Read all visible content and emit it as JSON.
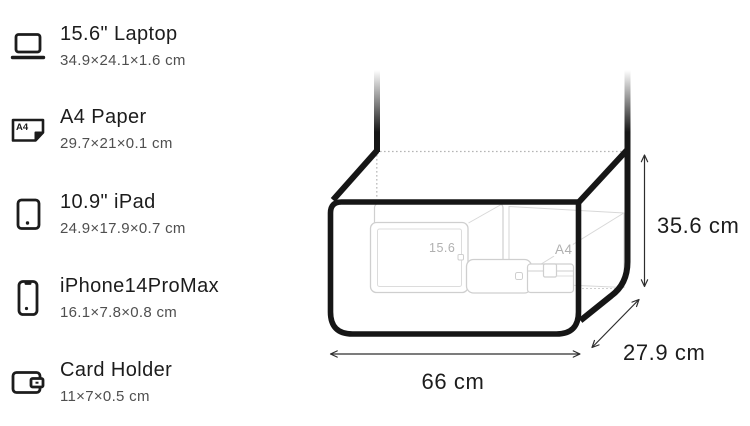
{
  "items_panel": {
    "a4_icon_text": "A4",
    "items": [
      {
        "icon": "laptop-icon",
        "title": "15.6\" Laptop",
        "dimensions": "34.9×24.1×1.6 cm"
      },
      {
        "icon": "a4-paper-icon",
        "title": "A4 Paper",
        "dimensions": "29.7×21×0.1 cm"
      },
      {
        "icon": "ipad-icon",
        "title": "10.9\" iPad",
        "dimensions": "24.9×17.9×0.7 cm"
      },
      {
        "icon": "iphone-icon",
        "title": "iPhone14ProMax",
        "dimensions": "16.1×7.8×0.8 cm"
      },
      {
        "icon": "card-holder-icon",
        "title": "Card Holder",
        "dimensions": "11×7×0.5 cm"
      }
    ]
  },
  "diagram": {
    "bag_width_label": "66 cm",
    "bag_depth_label": "27.9 cm",
    "bag_height_label": "35.6 cm",
    "inner_tags": {
      "laptop": "15.6",
      "a4_paper": "A4"
    }
  },
  "colors": {
    "bag_outline": "#161616",
    "faint_item_stroke": "#cfcfcf",
    "label_dark": "#1c1c1c",
    "label_gray": "#4f4f4f",
    "tag_gray": "#b0b0b0"
  }
}
